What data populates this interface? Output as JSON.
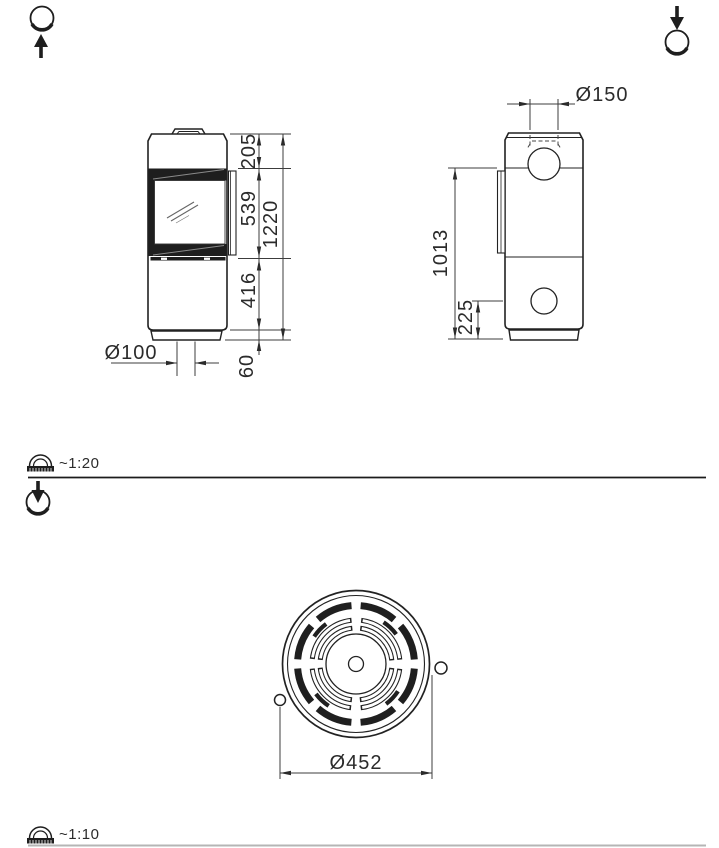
{
  "drawing_title": "stove-dimension-drawing",
  "front_view": {
    "dim_top_section": "205",
    "dim_door_window": "539",
    "dim_lower_section": "416",
    "dim_plinth": "60",
    "dim_total_height": "1220",
    "dim_air_inlet_diameter": "Ø100"
  },
  "side_view": {
    "dim_flue_diameter": "Ø150",
    "dim_rear_flue_height": "1013",
    "dim_rear_inlet_height": "225"
  },
  "top_view": {
    "dim_body_diameter": "Ø452"
  },
  "scales": {
    "elevation_views": "~1:20",
    "top_view": "~1:10"
  },
  "colors": {
    "line": "#2a2a2a",
    "dark_fill": "#1e1e1e",
    "divider_light": "#b5b5b5"
  }
}
